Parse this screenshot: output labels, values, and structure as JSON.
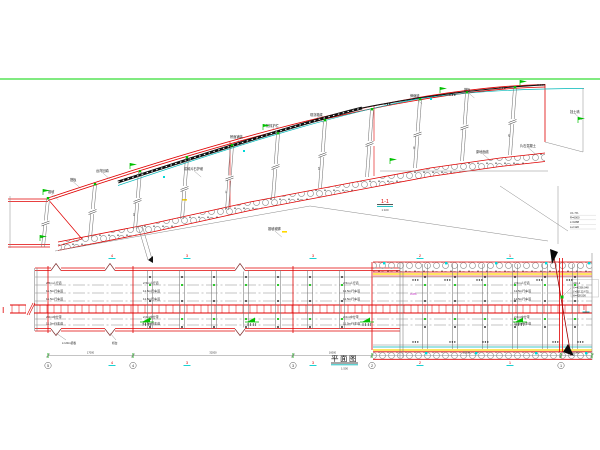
{
  "colors": {
    "accent_red": "#e00000",
    "marker_green": "#00c000",
    "water_cyan": "#00b8b8",
    "strip_yellow": "#ffd800",
    "note_magenta": "#bb00bb",
    "border_green": "#00d400"
  },
  "elevation": {
    "section_label": "1-1",
    "section_scale": "1:100",
    "curve_note": [
      "i=1.7%",
      "R=6000",
      "L=1088",
      "Ls=120"
    ],
    "labels": [
      {
        "t": "锥坡",
        "x": 48,
        "y": 193
      },
      {
        "t": "搭板",
        "x": 70,
        "y": 181
      },
      {
        "t": "台背回填",
        "x": 96,
        "y": 172
      },
      {
        "t": "浆砌片石护坡",
        "x": 184,
        "y": 170
      },
      {
        "t": "桥面铺装",
        "x": 230,
        "y": 138
      },
      {
        "t": "防撞护栏",
        "x": 266,
        "y": 127
      },
      {
        "t": "现浇箱梁",
        "x": 310,
        "y": 116
      },
      {
        "t": "伸缩缝",
        "x": 410,
        "y": 97
      },
      {
        "t": "搭板",
        "x": 464,
        "y": 91
      },
      {
        "t": "原地面线",
        "x": 476,
        "y": 153
      },
      {
        "t": "片石混凝土",
        "x": 520,
        "y": 147
      },
      {
        "t": "挡土墙",
        "x": 570,
        "y": 113
      },
      {
        "t": "锥坡坡脚",
        "x": 268,
        "y": 230
      }
    ],
    "pile_dims": [
      "15",
      "15",
      "16",
      "16",
      "17",
      "17",
      "18",
      "18",
      "19",
      "19",
      "20"
    ]
  },
  "plan": {
    "title": "平面图",
    "scale": "1:500",
    "row_labels": [
      "2.5m人行道",
      "11.5m行车道",
      "11.5m行车道",
      "2.0m中分带",
      "11.5m行车道"
    ],
    "span_labels_top": [
      "4",
      "3",
      "3",
      "2",
      "1"
    ],
    "span_labels_bottom": [
      "4",
      "3",
      "3",
      "2",
      "1"
    ],
    "pier_numbers": [
      "5",
      "4",
      "3",
      "2",
      "1"
    ],
    "dimensions": [
      "17000",
      "32000",
      "16000",
      "37800",
      "6300"
    ],
    "abutment_labels": [
      "L=20m搭板",
      "桥台"
    ],
    "median_grade": "i=2%",
    "section_marker": "Ⅰ",
    "note": {
      "title": "J24-1",
      "lines": [
        "X=40356.048",
        "Y=95123.675",
        "H=428.500"
      ]
    }
  }
}
